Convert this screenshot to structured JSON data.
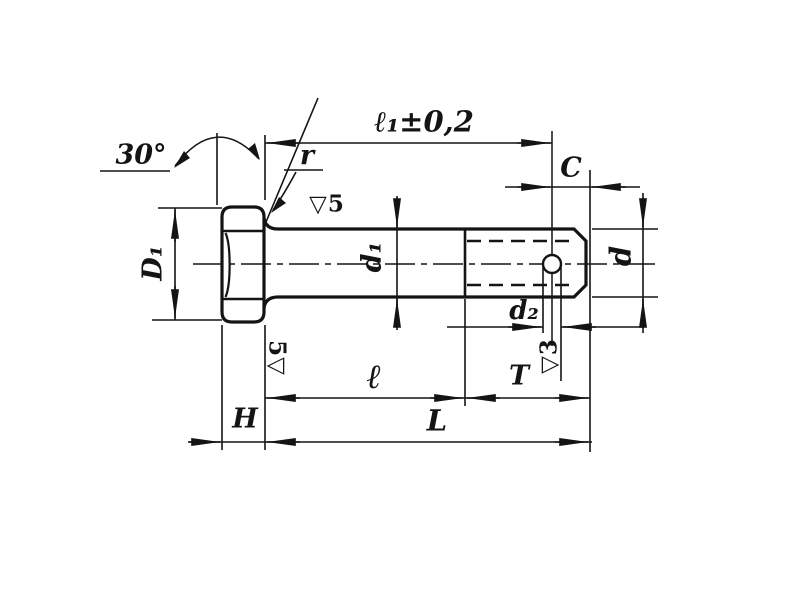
{
  "title": "Hex-head bolt with cotter-pin hole — dimensioned engineering drawing",
  "ink_color": "#141414",
  "background_color": "#ffffff",
  "labels": {
    "head_chamfer_angle": "30°",
    "fillet_radius": "r",
    "length_to_hole_with_tolerance": "ℓ₁±0,2",
    "end_chamfer": "C",
    "head_diameter": "D₁",
    "shank_diameter": "d₁",
    "shank_surface_finish": "▽5",
    "thread_diameter": "d",
    "hole_diameter": "d₂",
    "thread_surface_finish": "▽3",
    "bearing_surface_finish": "5▽",
    "grip_length": "ℓ",
    "thread_length": "T",
    "bolt_length": "L",
    "head_height": "H"
  }
}
